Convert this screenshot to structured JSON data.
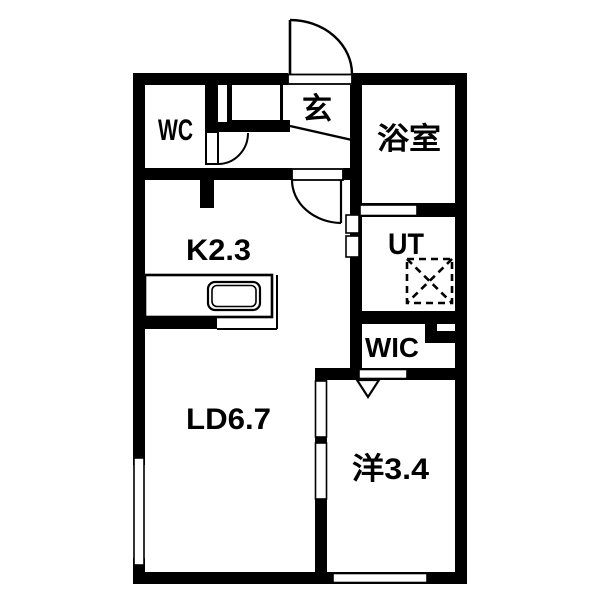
{
  "page": {
    "background": "#ffffff"
  },
  "plan": {
    "type": "apartment-floor-plan",
    "wall_color": "#000000",
    "floor_color": "#ffffff",
    "rooms": [
      {
        "id": "wc",
        "label": "WC"
      },
      {
        "id": "genkan",
        "label": "玄"
      },
      {
        "id": "bathroom",
        "label": "浴室"
      },
      {
        "id": "kitchen",
        "label": "K2.3"
      },
      {
        "id": "utility",
        "label": "UT"
      },
      {
        "id": "wic",
        "label": "WIC"
      },
      {
        "id": "living-dining",
        "label": "LD6.7"
      },
      {
        "id": "bedroom",
        "label": "洋3.4"
      }
    ],
    "fixtures": {
      "kitchen_sink": "sink-counter",
      "washer_space": "dashed-square-with-x",
      "entrance_door": "swing-door-arc",
      "wic_door": "triangle-mark"
    }
  }
}
